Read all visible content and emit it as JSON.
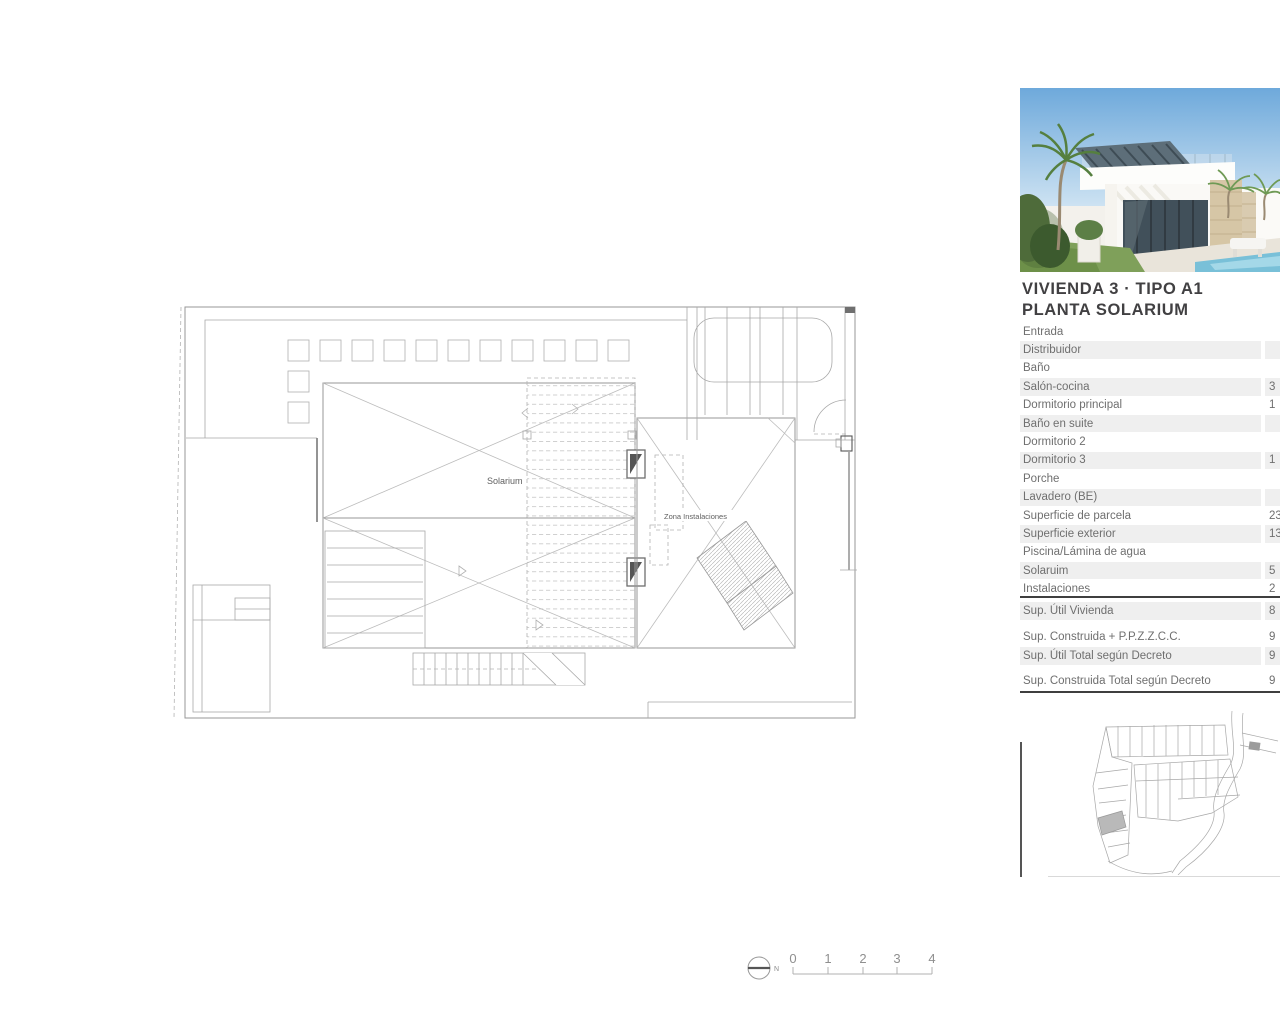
{
  "panel": {
    "title_line1": "VIVIENDA 3 · TIPO A1",
    "title_line2": "PLANTA SOLARIUM",
    "rooms": [
      {
        "label": "Entrada",
        "value": ""
      },
      {
        "label": "Distribuidor",
        "value": ""
      },
      {
        "label": "Baño",
        "value": ""
      },
      {
        "label": "Salón-cocina",
        "value": "3"
      },
      {
        "label": "Dormitorio principal",
        "value": "1"
      },
      {
        "label": "Baño en suite",
        "value": ""
      },
      {
        "label": "Dormitorio 2",
        "value": ""
      },
      {
        "label": "Dormitorio 3",
        "value": "1"
      },
      {
        "label": "Porche",
        "value": ""
      },
      {
        "label": "Lavadero (BE)",
        "value": ""
      },
      {
        "label": "Superficie de parcela",
        "value": "23"
      },
      {
        "label": "Superficie exterior",
        "value": "13"
      },
      {
        "label": "Piscina/Lámina de agua",
        "value": ""
      },
      {
        "label": "Solaruim",
        "value": "5"
      },
      {
        "label": "Instalaciones",
        "value": "2"
      }
    ],
    "summary": [
      {
        "label": "Sup. Útil Vivienda",
        "value": "8"
      },
      {
        "label": "Sup. Construida + P.P.Z.Z.C.C.",
        "value": "9"
      },
      {
        "label": "Sup. Útil Total según Decreto",
        "value": "9"
      },
      {
        "label": "Sup. Construida Total según Decreto",
        "value": "9"
      }
    ]
  },
  "plan": {
    "solarium_label": "Solarium",
    "instalaciones_label": "Zona Instalaciones",
    "compass_label": "N",
    "scale_ticks": [
      "0",
      "1",
      "2",
      "3",
      "4"
    ]
  },
  "colors": {
    "row_alt_bg": "#efefef",
    "rule_dark": "#3f3f3f",
    "plan_line": "#a8a8a8",
    "highlight_parcel": "#b9b9b9"
  }
}
